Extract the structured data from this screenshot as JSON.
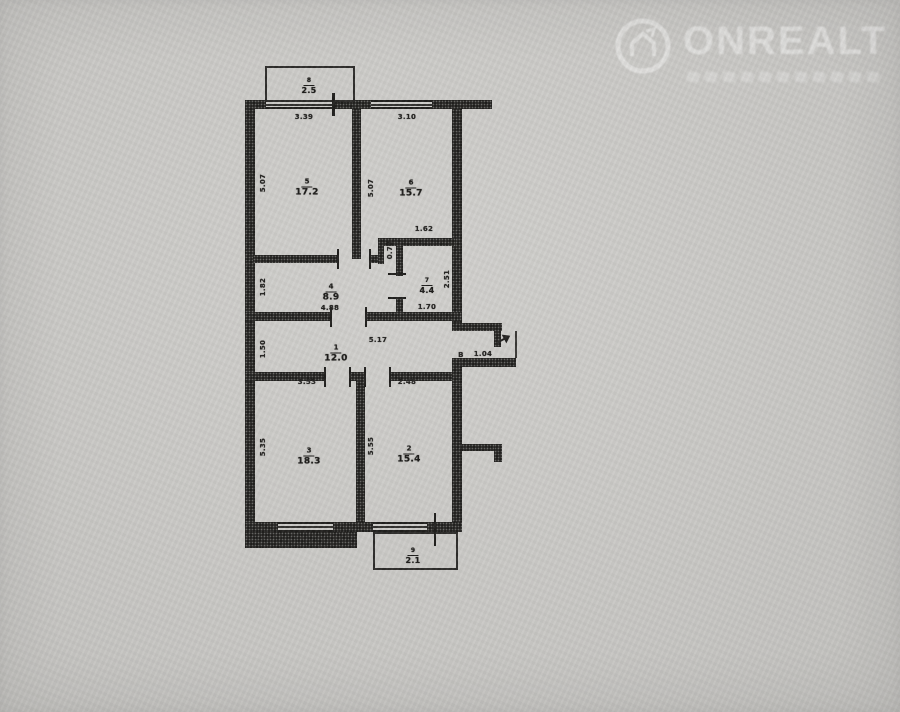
{
  "watermark": {
    "brand": "ONREALT",
    "logo_icon": "house-in-circle-icon"
  },
  "colors": {
    "paper": "#c9c8c5",
    "ink": "#201f1d",
    "watermark_text": "rgba(255,255,255,0.40)"
  },
  "plan": {
    "type": "apartment-floor-plan",
    "rooms": [
      {
        "number": "8",
        "area": "2.5",
        "x": 309,
        "y": 81,
        "small": true
      },
      {
        "number": "5",
        "area": "17.2",
        "x": 307,
        "y": 183,
        "small": false
      },
      {
        "number": "6",
        "area": "15.7",
        "x": 411,
        "y": 184,
        "small": false
      },
      {
        "number": "4",
        "area": "8.9",
        "x": 331,
        "y": 288,
        "small": false
      },
      {
        "number": "7",
        "area": "4.4",
        "x": 427,
        "y": 281,
        "small": true
      },
      {
        "number": "1",
        "area": "12.0",
        "x": 336,
        "y": 349,
        "small": false
      },
      {
        "number": "3",
        "area": "18.3",
        "x": 309,
        "y": 452,
        "small": false
      },
      {
        "number": "2",
        "area": "15.4",
        "x": 409,
        "y": 450,
        "small": false
      },
      {
        "number": "9",
        "area": "2.1",
        "x": 413,
        "y": 551,
        "small": true
      }
    ],
    "dimensions": [
      {
        "v": "3.39",
        "x": 304,
        "y": 117,
        "o": "h"
      },
      {
        "v": "3.10",
        "x": 407,
        "y": 117,
        "o": "h"
      },
      {
        "v": "5.07",
        "x": 263,
        "y": 183,
        "o": "v"
      },
      {
        "v": "5.07",
        "x": 371,
        "y": 188,
        "o": "v"
      },
      {
        "v": "1.62",
        "x": 424,
        "y": 229,
        "o": "h"
      },
      {
        "v": "0.79",
        "x": 390,
        "y": 250,
        "o": "v"
      },
      {
        "v": "2.51",
        "x": 447,
        "y": 279,
        "o": "v"
      },
      {
        "v": "1.82",
        "x": 263,
        "y": 287,
        "o": "v"
      },
      {
        "v": "4.88",
        "x": 330,
        "y": 308,
        "o": "h"
      },
      {
        "v": "1.70",
        "x": 427,
        "y": 307,
        "o": "h"
      },
      {
        "v": "1.50",
        "x": 263,
        "y": 349,
        "o": "v"
      },
      {
        "v": "5.17",
        "x": 378,
        "y": 340,
        "o": "h"
      },
      {
        "v": "В",
        "x": 461,
        "y": 355,
        "o": "h"
      },
      {
        "v": "1.04",
        "x": 483,
        "y": 354,
        "o": "h"
      },
      {
        "v": "3.53",
        "x": 307,
        "y": 382,
        "o": "h"
      },
      {
        "v": "2.48",
        "x": 407,
        "y": 382,
        "o": "h"
      },
      {
        "v": "5.35",
        "x": 263,
        "y": 447,
        "o": "v"
      },
      {
        "v": "5.55",
        "x": 371,
        "y": 446,
        "o": "v"
      }
    ]
  }
}
